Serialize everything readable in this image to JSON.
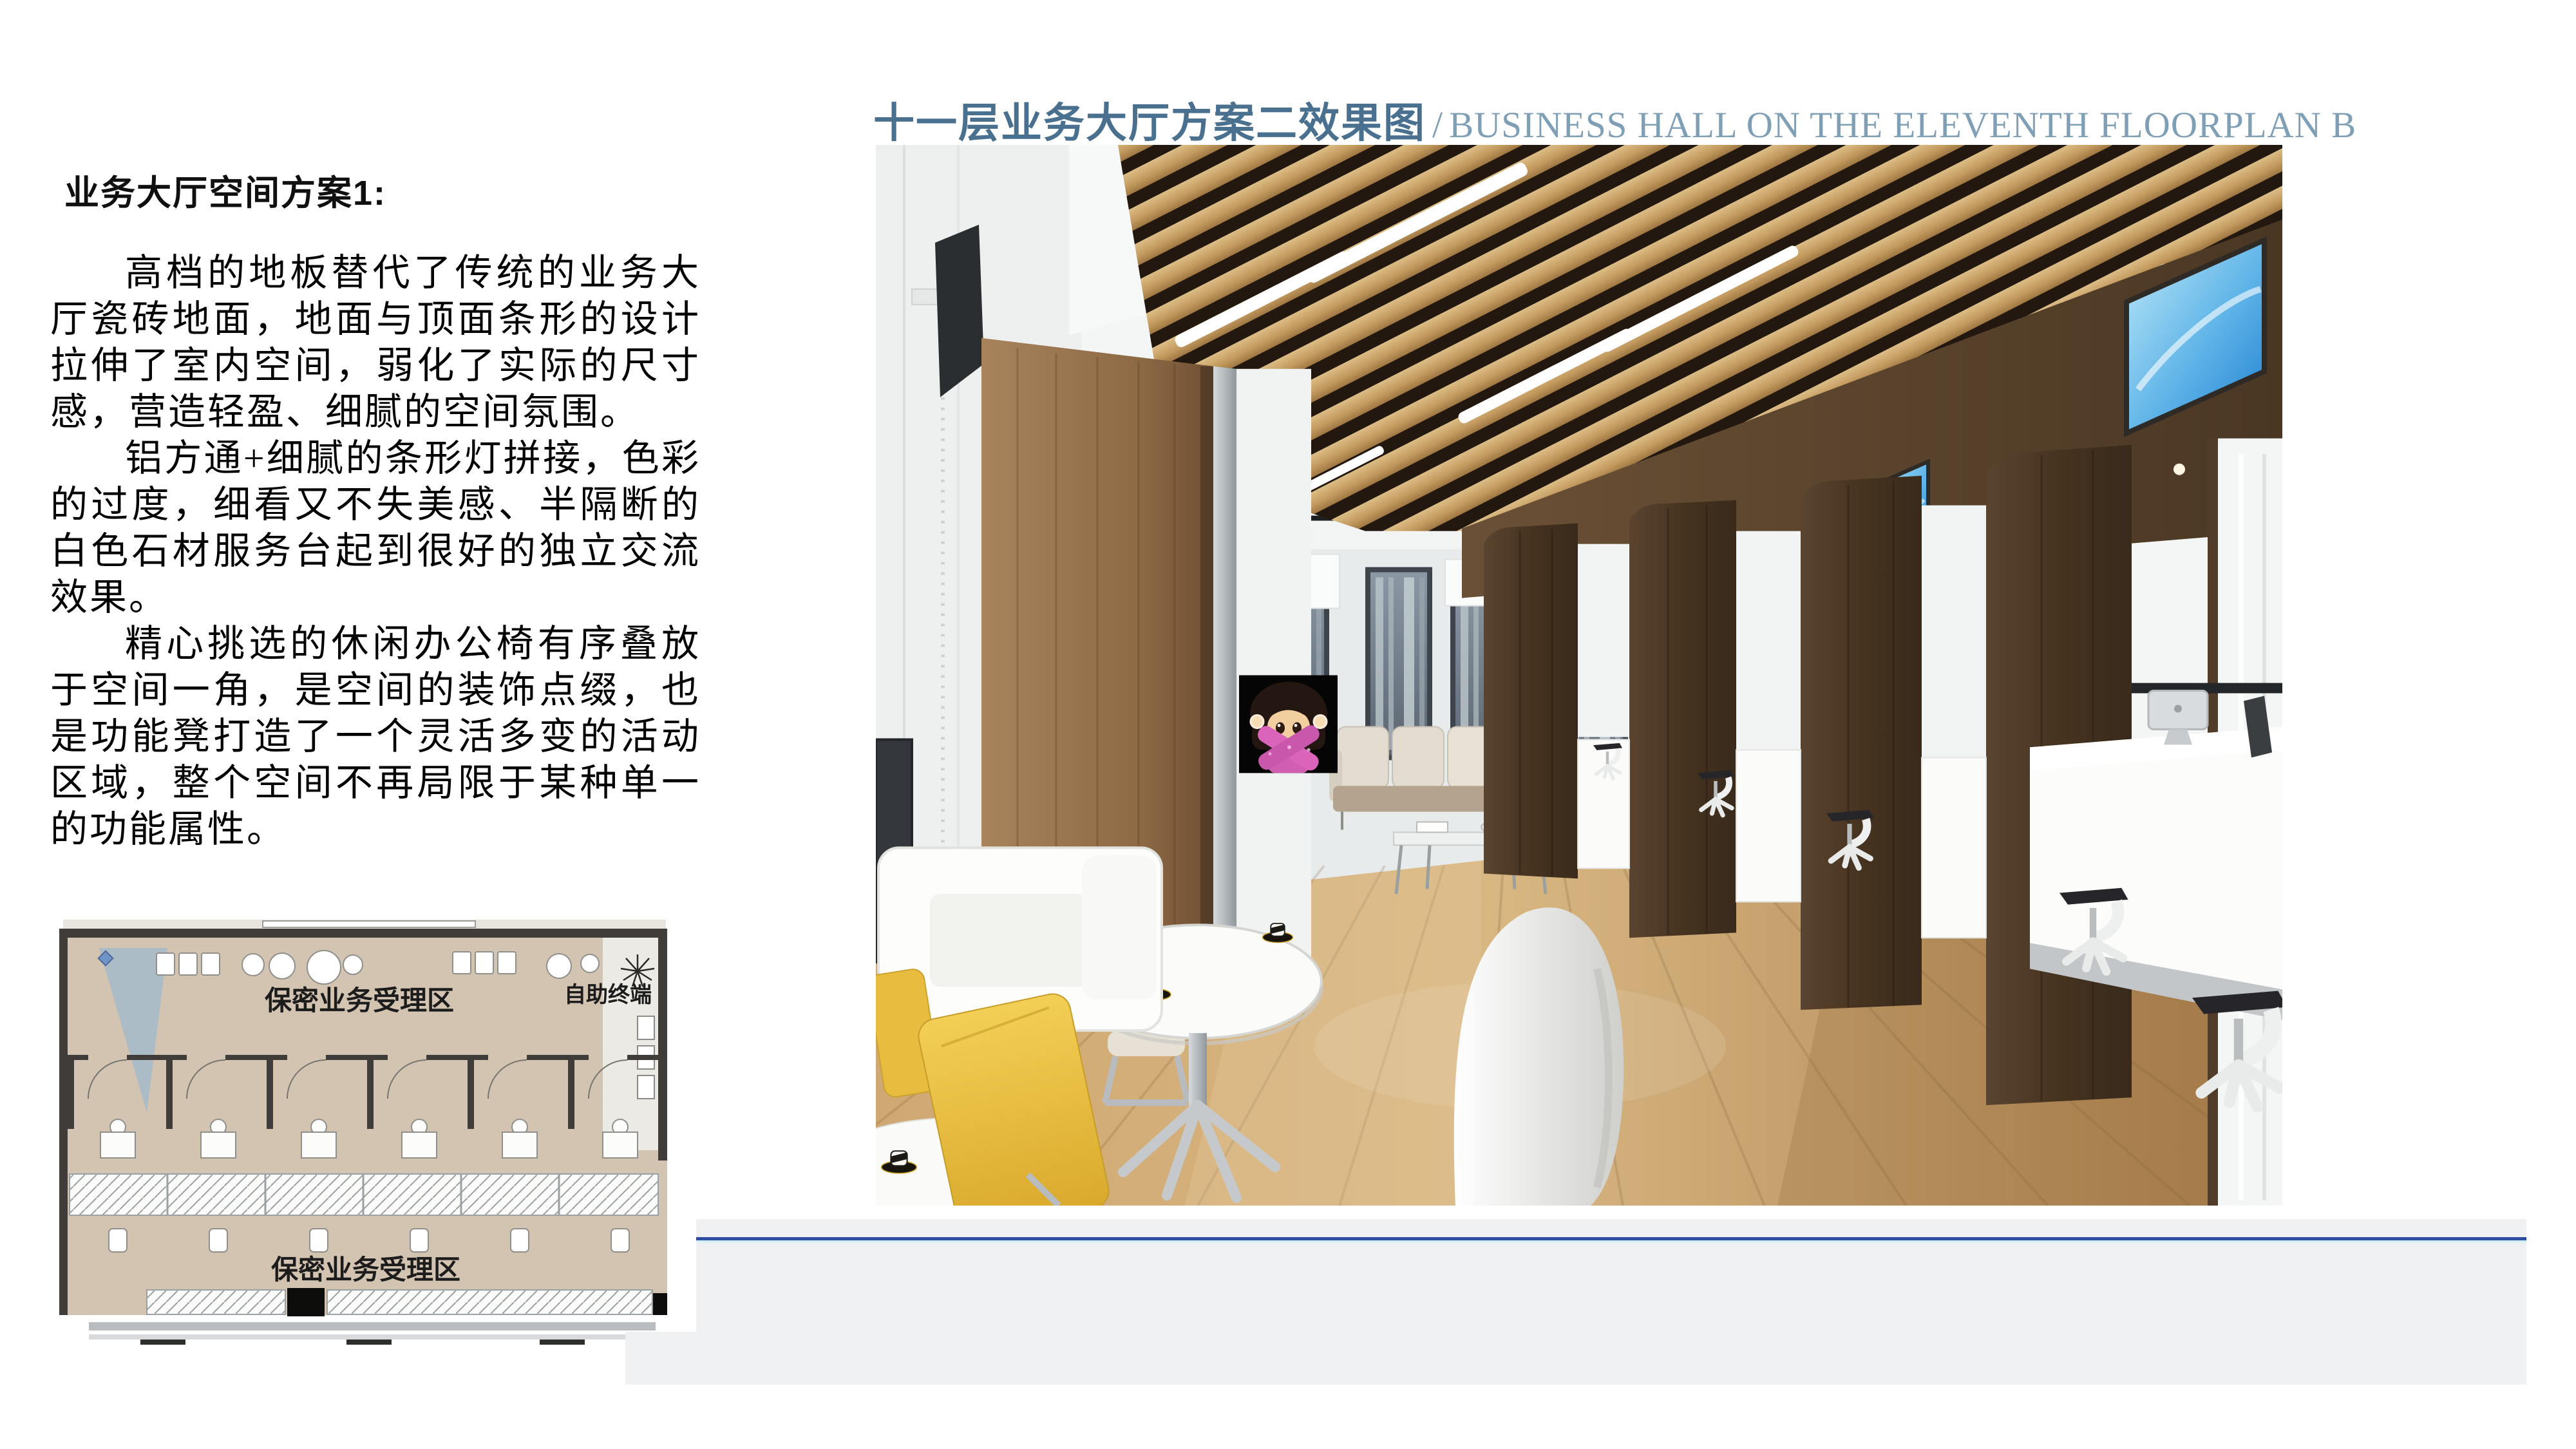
{
  "title": {
    "cn": "十一层业务大厅方案二效果图",
    "sep": "/",
    "en": "BUSINESS HALL ON THE ELEVENTH FLOORPLAN B",
    "cn_color": "#49708f",
    "en_color": "#7f9fb6"
  },
  "left_panel": {
    "heading": "业务大厅空间方案1:",
    "paragraphs": [
      "高档的地板替代了传统的业务大厅瓷砖地面，地面与顶面条形的设计拉伸了室内空间，弱化了实际的尺寸感，营造轻盈、细腻的空间氛围。",
      "铝方通+细腻的条形灯拼接，色彩的过度，细看又不失美感、半隔断的白色石材服务台起到很好的独立交流效果。",
      "精心挑选的休闲办公椅有序叠放于空间一角，是空间的装饰点缀，也是功能凳打造了一个灵活多变的活动区域，整个空间不再局限于某种单一的功能属性。"
    ]
  },
  "floor_plan": {
    "label_top": "保密业务受理区",
    "label_terminal": "自助终端",
    "label_bottom": "保密业务受理区",
    "floor_color": "#d3c4b2",
    "wall_color": "#3f3c39",
    "camera_cone_color": "#85b4dc"
  },
  "footer_band": {
    "background": "#eef0f1",
    "line_color": "#2e4d9e",
    "line_highlight": "#cdeffa"
  },
  "render_palette": {
    "slat_wood": "#c9a268",
    "slat_gap": "#23180f",
    "partition_wood": "#4e3a28",
    "floor_wood": "#c9a26c",
    "screen_blue": "#2e8fd8",
    "emoji_background": "#050505",
    "emoji_shirt_pink": "#d964ba"
  }
}
